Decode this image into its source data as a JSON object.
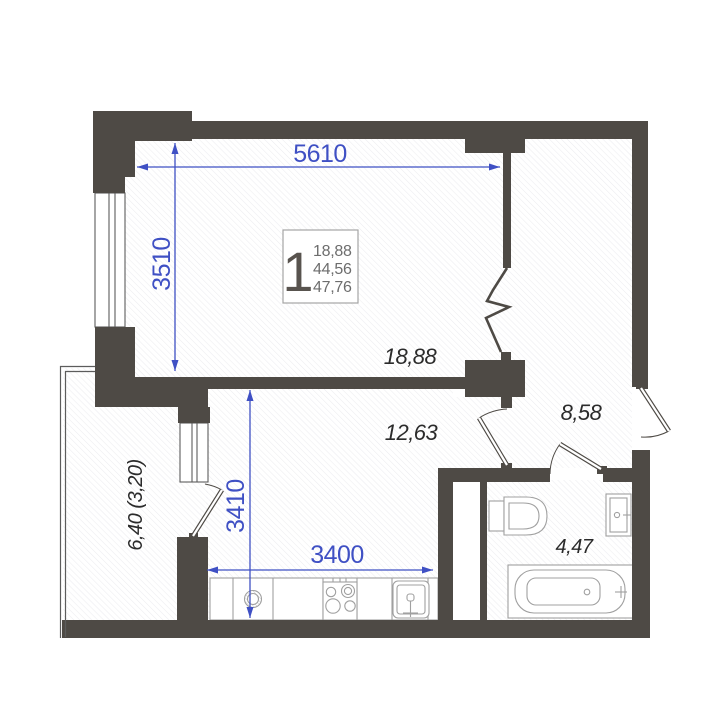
{
  "unit_card": {
    "room_count": "1",
    "living_area": "18,88",
    "area_without_balcony": "44,56",
    "total_area": "47,76"
  },
  "dimensions": {
    "living_width_mm": "5610",
    "living_depth_mm": "3510",
    "kitchen_depth_mm": "3410",
    "kitchen_width_mm": "3400"
  },
  "room_areas": {
    "living_room": "18,88",
    "kitchen": "12,63",
    "hallway": "8,58",
    "bathroom": "4,47",
    "balcony": "6,40 (3,20)"
  },
  "colors": {
    "wall": "#4e4a45",
    "dimension_blue": "#3f50c4",
    "label_text": "#2b2b2b",
    "fixture_stroke": "#a0a0a0",
    "hatch": "#ececef"
  }
}
